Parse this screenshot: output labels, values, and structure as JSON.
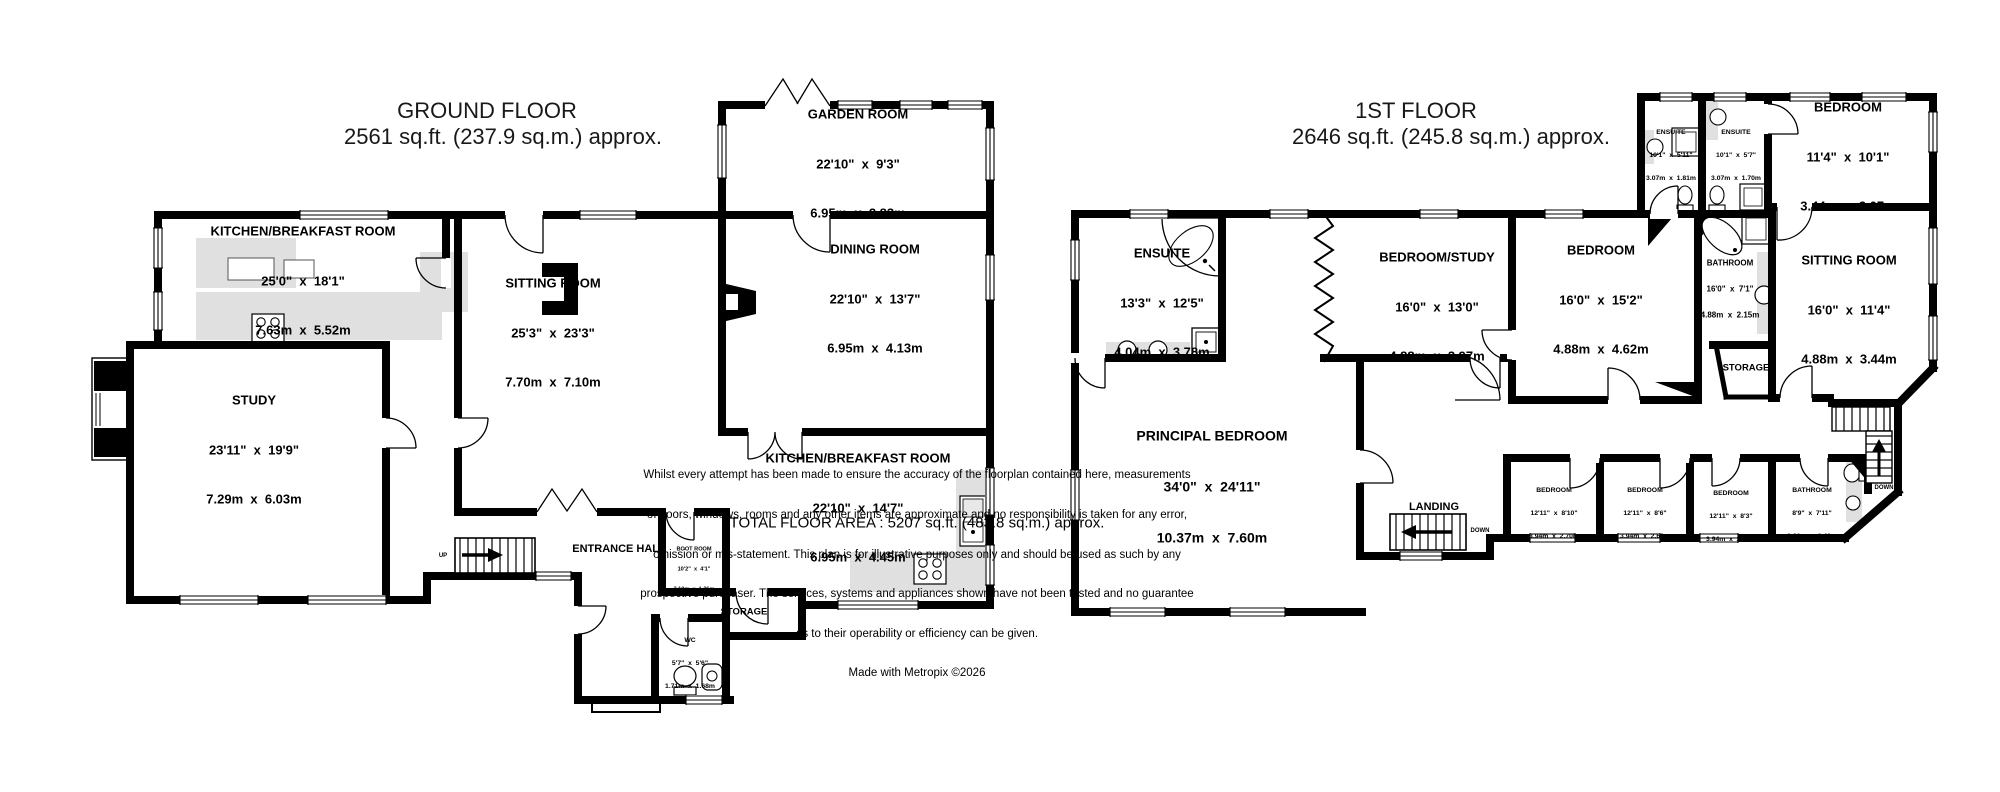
{
  "ground_floor": {
    "title": "GROUND FLOOR",
    "subtitle": "2561 sq.ft. (237.9 sq.m.) approx.",
    "rooms": {
      "garden_room": {
        "name": "GARDEN ROOM",
        "imperial": "22'10\"  x  9'3\"",
        "metric": "6.95m  x  2.83m"
      },
      "kitchen_breakfast": {
        "name": "KITCHEN/BREAKFAST ROOM",
        "imperial": "25'0\"  x  18'1\"",
        "metric": "7.63m  x  5.52m"
      },
      "sitting_room": {
        "name": "SITTING ROOM",
        "imperial": "25'3\"  x  23'3\"",
        "metric": "7.70m  x  7.10m"
      },
      "dining_room": {
        "name": "DINING ROOM",
        "imperial": "22'10\"  x  13'7\"",
        "metric": "6.95m  x  4.13m"
      },
      "study": {
        "name": "STUDY",
        "imperial": "23'11\"  x  19'9\"",
        "metric": "7.29m  x  6.03m"
      },
      "kitchen_breakfast_2": {
        "name": "KITCHEN/BREAKFAST ROOM",
        "imperial": "22'10\"  x  14'7\"",
        "metric": "6.95m  x  4.45m"
      },
      "entrance_hall": {
        "name": "ENTRANCE HALL"
      },
      "boot_room": {
        "name": "BOOT ROOM",
        "imperial": "10'2\"  x  4'1\"",
        "metric": "3.10m  x  1.26m"
      },
      "storage": {
        "name": "STORAGE"
      },
      "wc": {
        "name": "WC",
        "imperial": "5'7\"  x  5'6\"",
        "metric": "1.71m  x  1.68m"
      },
      "stairs_label": "UP"
    }
  },
  "first_floor": {
    "title": "1ST FLOOR",
    "subtitle": "2646 sq.ft. (245.8 sq.m.) approx.",
    "rooms": {
      "ensuite_1": {
        "name": "ENSUITE",
        "imperial": "10'1\"  x  5'11\"",
        "metric": "3.07m  x  1.81m"
      },
      "ensuite_2": {
        "name": "ENSUITE",
        "imperial": "10'1\"  x  5'7\"",
        "metric": "3.07m  x  1.70m"
      },
      "bedroom_top": {
        "name": "BEDROOM",
        "imperial": "11'4\"  x  10'1\"",
        "metric": "3.44m  x  3.07m"
      },
      "ensuite_main": {
        "name": "ENSUITE",
        "imperial": "13'3\"  x  12'5\"",
        "metric": "4.04m  x  3.78m"
      },
      "bedroom_study": {
        "name": "BEDROOM/STUDY",
        "imperial": "16'0\"  x  13'0\"",
        "metric": "4.88m  x  3.97m"
      },
      "bedroom_middle": {
        "name": "BEDROOM",
        "imperial": "16'0\"  x  15'2\"",
        "metric": "4.88m  x  4.62m"
      },
      "bathroom_1": {
        "name": "BATHROOM",
        "imperial": "16'0\"  x  7'1\"",
        "metric": "4.88m  x  2.15m"
      },
      "sitting_room": {
        "name": "SITTING ROOM",
        "imperial": "16'0\"  x  11'4\"",
        "metric": "4.88m  x  3.44m"
      },
      "storage": {
        "name": "STORAGE"
      },
      "principal_bedroom": {
        "name": "PRINCIPAL BEDROOM",
        "imperial": "34'0\"  x  24'11\"",
        "metric": "10.37m  x  7.60m"
      },
      "landing": {
        "name": "LANDING"
      },
      "bedroom_small_1": {
        "name": "BEDROOM",
        "imperial": "12'11\"  x  8'10\"",
        "metric": "3.94m  x  2.70m"
      },
      "bedroom_small_2": {
        "name": "BEDROOM",
        "imperial": "12'11\"  x  8'6\"",
        "metric": "3.94m  x  2.60m"
      },
      "bedroom_small_3": {
        "name": "BEDROOM",
        "imperial": "12'11\"  x  8'3\"",
        "metric": "3.94m  x  2.50m"
      },
      "bathroom_2": {
        "name": "BATHROOM",
        "imperial": "8'9\"  x  7'11\"",
        "metric": "2.66m  x  2.40m"
      },
      "stairs_label_main": "DOWN",
      "stairs_label_secondary": "DOWN"
    }
  },
  "footer": {
    "total_area": "TOTAL FLOOR AREA : 5207 sq.ft. (483.8 sq.m.) approx.",
    "disclaimer_lines": [
      "Whilst every attempt has been made to ensure the accuracy of the floorplan contained here, measurements",
      "of doors, windows, rooms and any other items are approximate and no responsibility is taken for any error,",
      "omission or mis-statement. This plan is for illustrative purposes only and should be used as such by any",
      "prospective purchaser. The services, systems and appliances shown have not been tested and no guarantee",
      "as to their operability or efficiency can be given."
    ],
    "credit": "Made with Metropix ©2026"
  },
  "colors": {
    "wall": "#000000",
    "fixture": "#e0e0e0",
    "background": "#ffffff"
  }
}
